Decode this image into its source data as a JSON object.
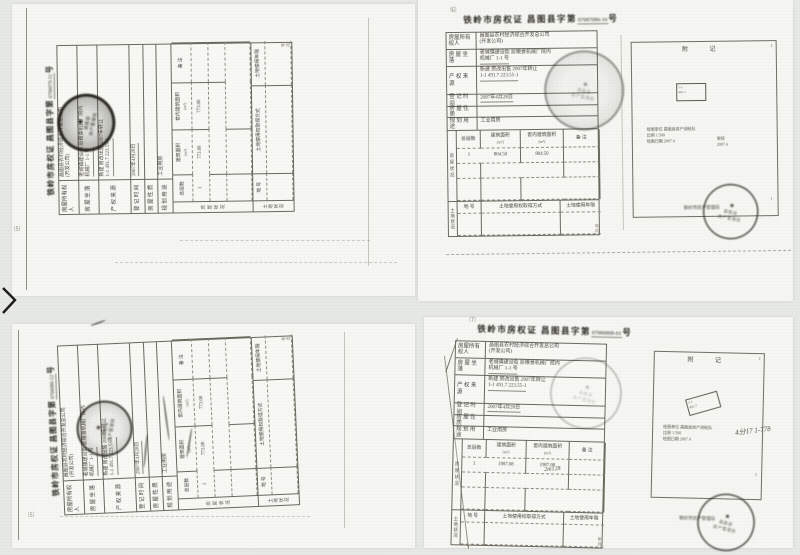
{
  "shared": {
    "title": {
      "city": "铁岭市房权证",
      "county": "昌图县字第",
      "suffix": "号"
    },
    "rows": [
      {
        "label": "房屋所有权人",
        "l1": "昌图县农村经济综合开发总公司",
        "l2": "(开发公司)"
      },
      {
        "label": "房 屋 坐 落",
        "l1": "老城镇建设街 原粮食机械厂院内",
        "l2": "机械厂 1-1 号"
      },
      {
        "label": "产 权 来 源",
        "l1": "新建 房改出售 2007年转让",
        "l2": "1-1  491.7  223.55-1"
      },
      {
        "label": "登 记 时 间",
        "l1": "2007年4月28日"
      },
      {
        "label": "房 屋 性 质",
        "l1": ""
      },
      {
        "label": "规 划 用 途",
        "l1": "工业用房"
      }
    ],
    "area": {
      "side": "房屋状况",
      "h1": "总层数",
      "h2": "建筑面积",
      "h2s": "(m²)",
      "h3": "套内建筑面积",
      "h3s": "(m²)",
      "h4": "备  注"
    },
    "land": {
      "side": "土地状况",
      "h1": "地  号",
      "h2": "土地使用权取得方式",
      "h3": "土地使用年限",
      "note1": "年",
      "note2": "月"
    },
    "annex": {
      "head": "附  记",
      "corner": "1",
      "bldg1": "1-1",
      "bldg2": "491.7",
      "cap1": "绘图单位 昌图县房产测绘队",
      "cap2": "比例 1:500",
      "cap3": "绘图日期 2007.4",
      "side1": "审核",
      "side2": "2007.4"
    },
    "stamp": {
      "star": "★",
      "line1": "昌图县",
      "line2": "房产管理局",
      "outside": "铁岭市房产管理局"
    }
  },
  "certs": {
    "tl": {
      "no": "0706079-11",
      "mark": "⑸",
      "c1": "1",
      "c2": "773.08",
      "c3": "773.08"
    },
    "tr": {
      "no": "07087086-16",
      "mark": "⑹",
      "c1": "1",
      "c2": "804.50",
      "c3": "804.50"
    },
    "bl": {
      "no": "0706080-12",
      "mark": "⑸",
      "c1": "1",
      "c2": "773.08",
      "c3": "773.08"
    },
    "br": {
      "no": "07080808-61",
      "mark": "⑺",
      "c1": "1",
      "c2": "1987.08",
      "c3": "1987.08",
      "hand": "4分17 1-778",
      "hand2": "2m128"
    }
  }
}
